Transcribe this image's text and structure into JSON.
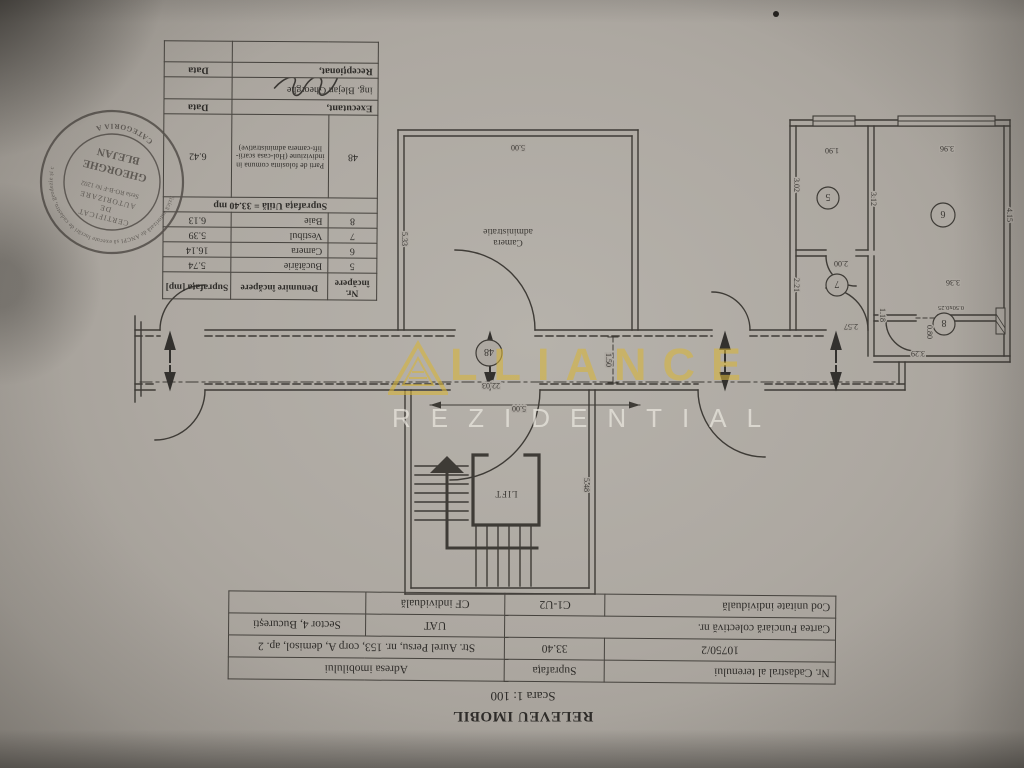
{
  "title_block": {
    "title": "RELEVEU IMOBIL",
    "scale": "Scara 1: 100"
  },
  "info_table": {
    "r1c1": "Nr. Cadastral al terenului",
    "r1c2": "Suprafața",
    "r1c3": "Adresa imobilului",
    "r2c1": "10750/2",
    "r2c2": "33.40",
    "r2c3": "Str. Aurel Persu, nr. 153, corp A, demisol, ap. 2",
    "r3c1": "Cartea Funciară colectivă nr.",
    "r3c2": "UAT",
    "r3c3": "Sector 4, București",
    "r4c1": "Cod unitate individuală",
    "r4c2": "C1-U2",
    "r4c3": "CF individuală",
    "r4c4": ""
  },
  "room_table": {
    "h_nr": "Nr. încăpere",
    "h_den": "Denumire încăpere",
    "h_sup": "Suprafața [mp]",
    "rows": [
      {
        "nr": "5",
        "den": "Bucătărie",
        "sup": "5.74"
      },
      {
        "nr": "6",
        "den": "Camera",
        "sup": "16.14"
      },
      {
        "nr": "7",
        "den": "Vestibul",
        "sup": "5.39"
      },
      {
        "nr": "8",
        "den": "Baie",
        "sup": "6.13"
      }
    ],
    "total": "Suprafața Utilă = 33.40 mp",
    "common_nr": "48",
    "common_den": "Parti de folosinta comuna in indiviziune (Hol-casa scarii-lift-camera administrative)",
    "common_sup": "6.42",
    "executant": "Executant,",
    "executant_data": "Data",
    "executant_name": "ing. Blejan Gheorghe",
    "receptionat": "Recepționat,",
    "receptionat_data": "Data"
  },
  "stamp": {
    "ring_text": "Persoană fizică autorizată de ANCPI să execute lucrări de cadastru, geodezie și cartografie",
    "category": "CATEGORIA A",
    "l1": "CERTIFICAT",
    "l2": "DE",
    "l3": "AUTORIZARE",
    "l4": "Seria RO-B-F Nr 1202",
    "name1": "GHEORGHE",
    "name2": "BLEJAN"
  },
  "watermark": {
    "wordmark": "LLIANCE",
    "subtitle": "REZIDENTIAL",
    "accent": "#d5b43e"
  },
  "plan": {
    "room_admin_l1": "administratie",
    "room_admin_l2": "Camera",
    "lift": "LIFT",
    "corridor_no": "48",
    "rooms": {
      "r5": "5",
      "r6": "6",
      "r7": "7",
      "r8": "8"
    },
    "dims": {
      "d500_top": "5.00",
      "d533": "5.33",
      "d190": "1.90",
      "d396": "3.96",
      "d302": "3.02",
      "d312": "3.12",
      "d415": "4.15",
      "d336": "3.36",
      "d200": "2.00",
      "d221": "2.21",
      "d257": "2.57",
      "d118": "1.18",
      "d080": "0.80",
      "d329": "3.29",
      "dwin": "0.50x0.25",
      "d2203": "22,03",
      "d500_cor": "5.00",
      "d150": "1.50",
      "d548": "5.48"
    }
  }
}
